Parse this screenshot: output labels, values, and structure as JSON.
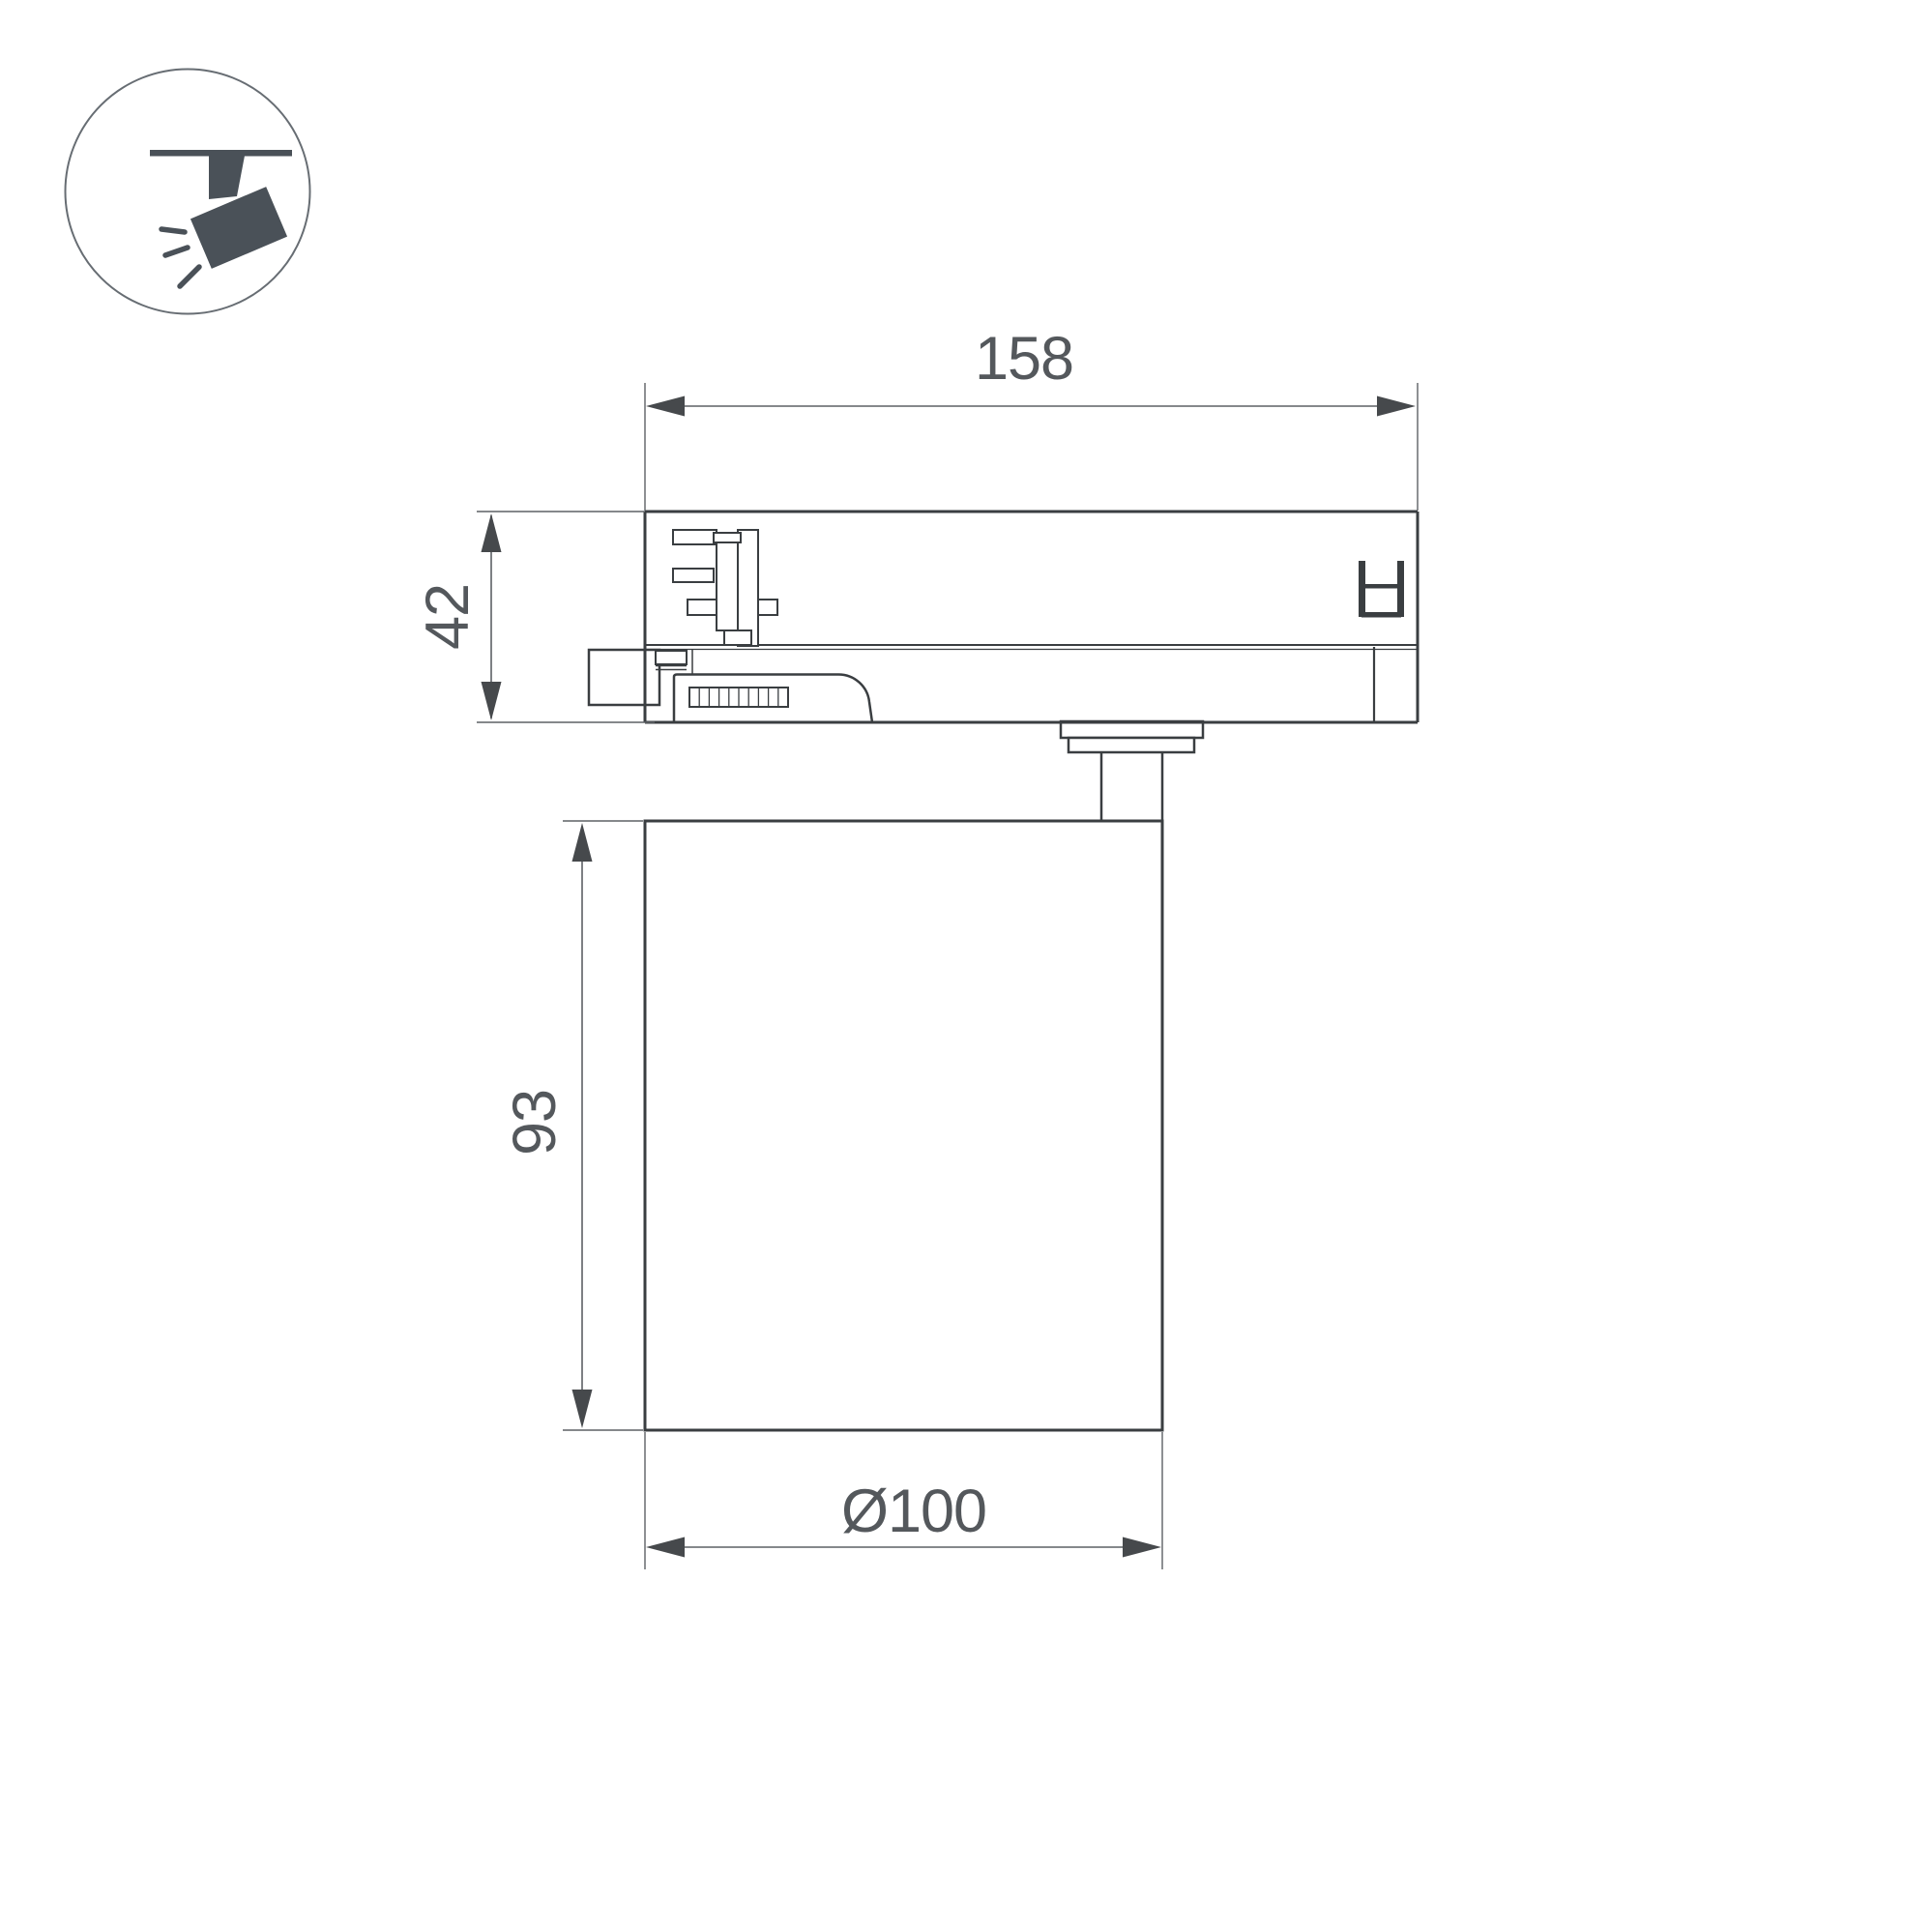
{
  "colors": {
    "background": "#ffffff",
    "object_line": "#3a3e41",
    "dimension_line": "#5d6165",
    "dimension_arrow": "#46494c",
    "dimension_text": "#54585c",
    "icon_fill": "#4a5158",
    "icon_circle_stroke": "#676d73"
  },
  "icon": {
    "name": "track-spotlight"
  },
  "dimensions": {
    "width": "158",
    "adapter_height": "42",
    "body_height": "93",
    "diameter": "Ø100"
  }
}
